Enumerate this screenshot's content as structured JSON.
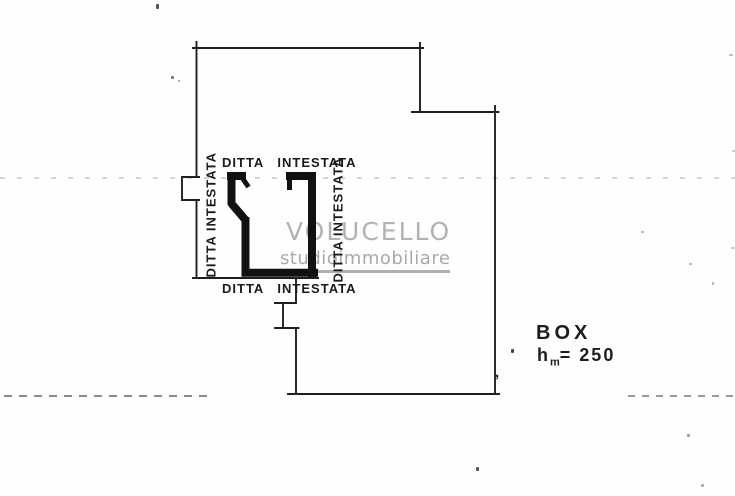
{
  "plan": {
    "unit_labels": {
      "top": "DITTA INTESTATA",
      "bottom": "DITTA INTESTATA",
      "left": "DITTA INTESTATA",
      "right": "DITTA INTESTATA"
    },
    "annotation": {
      "title": "BOX",
      "height_symbol": "h",
      "height_subscript": "m",
      "height_value": "= 250"
    }
  },
  "watermark": {
    "name": "VOLUCELLO",
    "tagline": "studioimmobiliare"
  },
  "artifacts": {
    "comma_mark": ","
  },
  "colors": {
    "ink": "#1f1f1f",
    "watermark_text": "#b2b2b2",
    "watermark_underline": "#b0b0b0"
  }
}
